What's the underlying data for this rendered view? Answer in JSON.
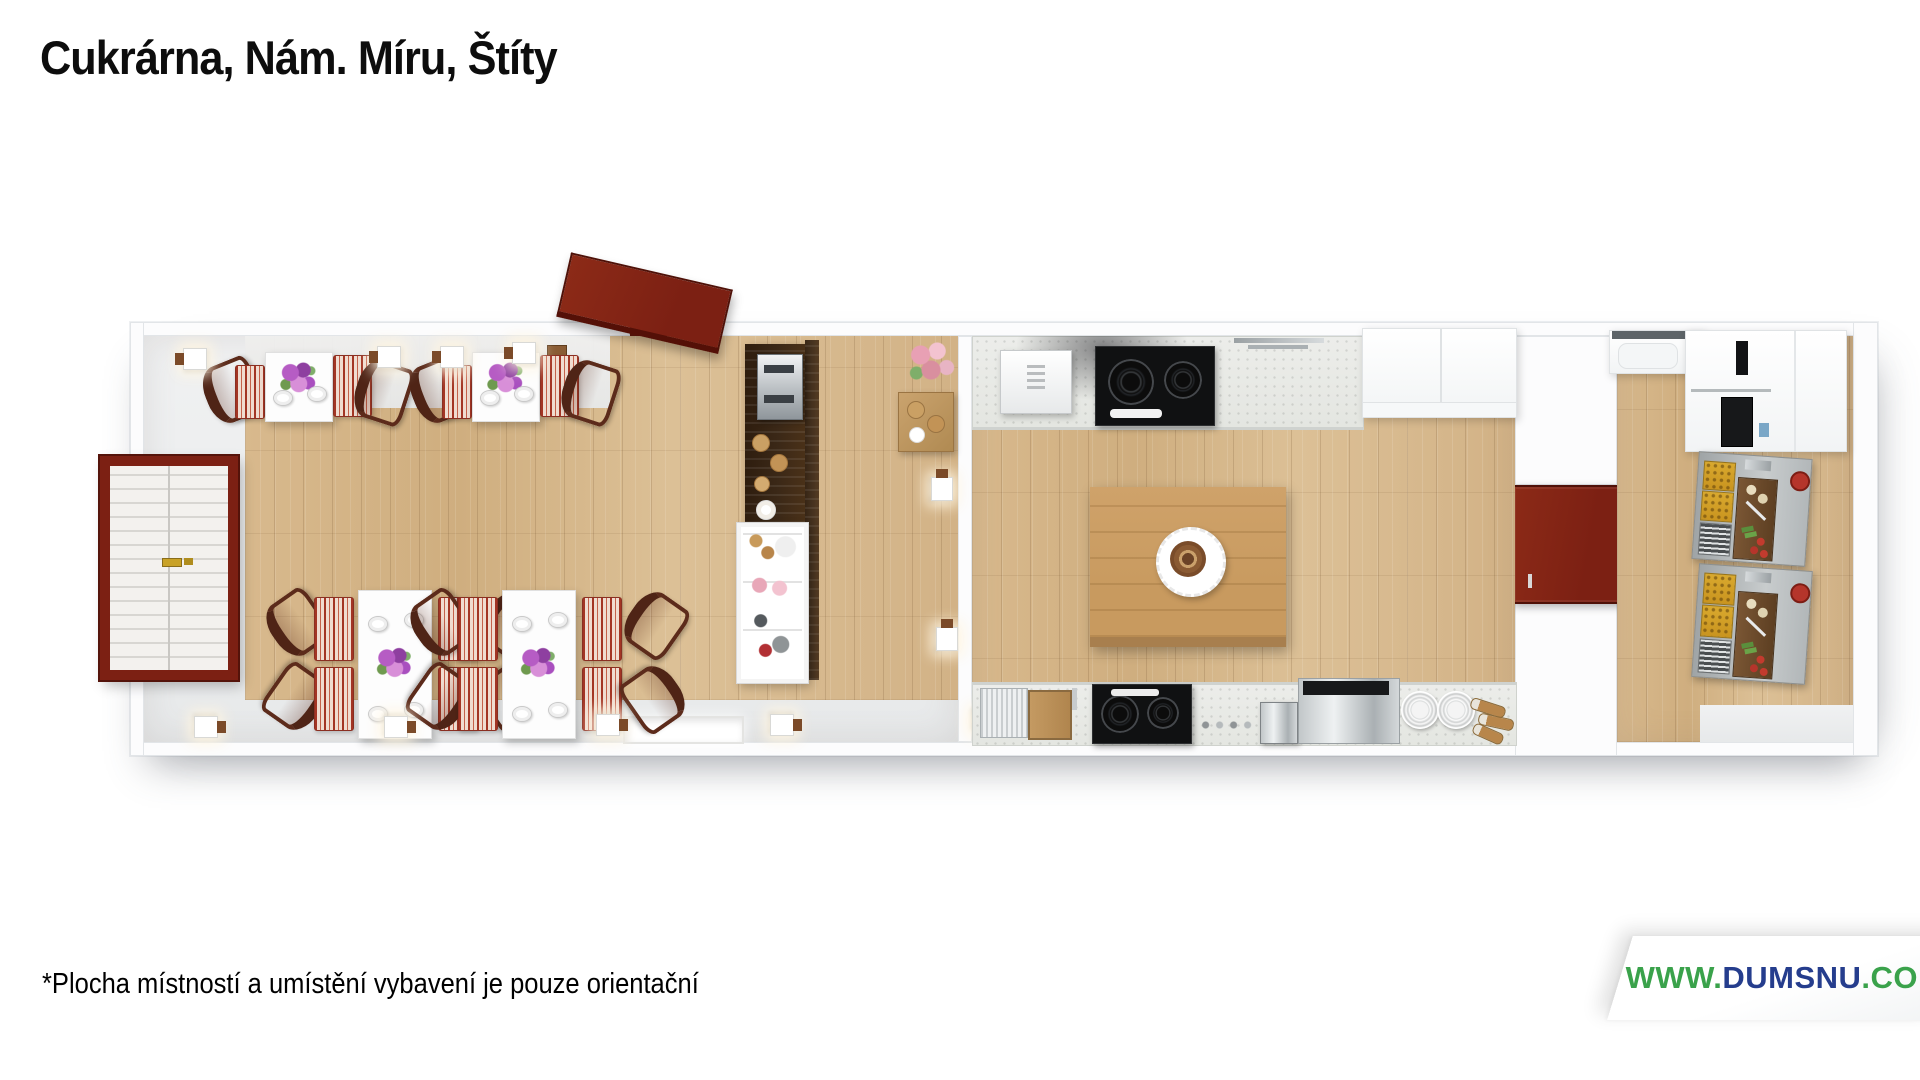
{
  "header": {
    "title": "Cukrárna, Nám. Míru, Štíty"
  },
  "footnote": {
    "text": "*Plocha místností a umístění vybavení je pouze orientační"
  },
  "watermark": {
    "prefix": "WWW.",
    "name": "DUMSNU",
    "suffix": ".COM",
    "prefix_color": "#3aa24b",
    "name_color": "#253d8d",
    "suffix_color": "#3aa24b"
  },
  "floor_plan": {
    "style": "3d-top-down-render",
    "rooms": [
      {
        "id": "cafe",
        "label": "café seating area"
      },
      {
        "id": "kitchen",
        "label": "kitchen"
      },
      {
        "id": "storage",
        "label": "back prep room"
      }
    ],
    "colors": {
      "door_red": "#7c2013",
      "bench_red": "#a33524",
      "wood_floor": "#d4b385",
      "island_wood": "#c89a5f",
      "bar_walnut": "#3b2817",
      "counter_gray": "#e9eae6",
      "wall_white": "#fcfcfd"
    }
  }
}
